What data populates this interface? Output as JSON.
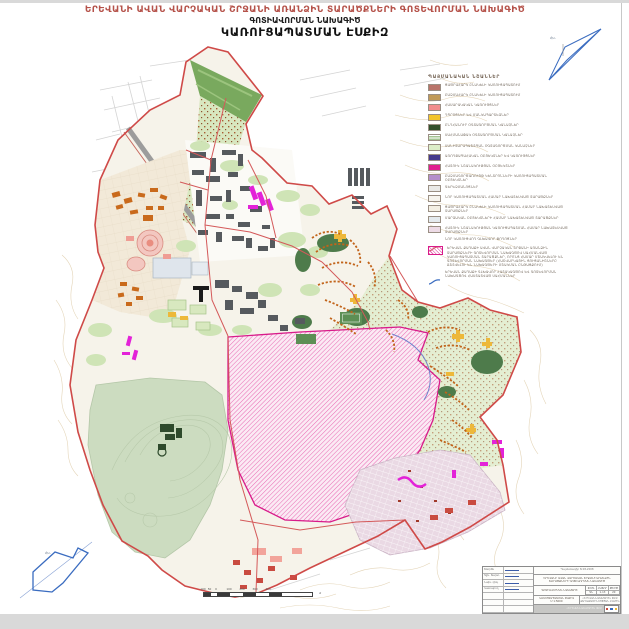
{
  "page": {
    "title_main": "ԵՐԵՎԱՆԻ ԱՎԱՆ ՎԱՐՉԱԿԱՆ ՇՐՋԱՆԻ ԱՌԱՆՁԻՆ ՏԱՐԱԾՔՆԵՐԻ ԳՈՏԵՎՈՐՄԱՆ ՆԱԽԱԳԻԾ",
    "title_sub1": "ԳՈՏԻԱՎՈՐՄԱՆ ՆԱԽԱԳԻԾ",
    "title_sub2": "ԿԱՌՈՒՑԱՊԱՏՄԱՆ ԷՍՔԻԶ",
    "north_label": "Հս."
  },
  "colors": {
    "title_red": "#b5524a",
    "boundary_red": "#cf4a48",
    "hatch_magenta": "#d81b8a",
    "north_blue": "#3a6cc0",
    "park_green": "#ccdcc0"
  },
  "legend": {
    "title": "ՊԱՅՄԱՆԱԿԱՆ ՆՇԱՆՆԵՐ",
    "items": [
      {
        "type": "swatch",
        "color": "#b9746a",
        "label": "ՑԱԾՐԱՀԱՐԿ ԲՆԱԿԵԼԻ ԿԱՌՈՒՑԱՊԱՏՈՒՄ"
      },
      {
        "type": "swatch",
        "color": "#c09a58",
        "label": "ԲԱԶՄԱՀԱՐԿ ԲՆԱԿԵԼԻ ԿԱՌՈՒՑԱՊԱՏՈՒՄ"
      },
      {
        "type": "swatch",
        "color": "#f28d8d",
        "label": "ՀԱՍԱՐԱԿԱԿԱՆ ԿԱՌՈՒՅՑՆԵՐ"
      },
      {
        "type": "swatch",
        "color": "#f3c52c",
        "label": "ԴՊՐՈՑՆԵՐ ԵՎ ՄԱՆԿԱՊԱՐՏԵԶՆԵՐ"
      },
      {
        "type": "swatch",
        "color": "#33512e",
        "label": "ԸՆԴՀԱՆՈՒՐ ՕԳՏԱԳՈՐԾՄԱՆ ԿԱՆԱՉՆԵՐ"
      },
      {
        "type": "swatch-dash",
        "color": "#a4c492",
        "label": "ՍԱՀՄԱՆԱՓԱԿ ՕԳՏԱԳՈՐԾՄԱՆ ԿԱՆԱՉՆԵՐ"
      },
      {
        "type": "swatch",
        "color": "#dcedc8",
        "label": "ՍԱՆԻՏԱՐԱՊԱՇՏՊԱՆ ՕԳՏԱԳՈՐԾՄԱՆ ԿԱՆԱՉՆԵՐ"
      },
      {
        "type": "swatch",
        "color": "#463a8e",
        "label": "ԱՌՈՂՋԱՊԱՀԱԿԱՆ ՕԲՅԵԿՏՆԵՐ ԵՎ ԿԱՌՈՒՅՑՆԵՐ"
      },
      {
        "type": "swatch",
        "color": "#e01f8f",
        "label": "ՀԱՏՈՒԿ ՆՇԱՆԱԿՈՒԹՅԱՆ ՕԲՅԵԿՏՆԵՐ"
      },
      {
        "type": "swatch",
        "color": "#b48fcb",
        "label": "ԲԱԶՄԱԳՈՐԾԱՌՈՒՅԹ ԿԵՆՏՐՈՆՆԵՐԻ ԿԱՌՈՒՑԱՊԱՏՄԱՆ ՕԲՅԵԿՏՆԵՐ"
      },
      {
        "type": "swatch",
        "color": "#e9e9e7",
        "label": "ԳԵՐԵԶՄԱՆՈՑՆԵՐ"
      },
      {
        "type": "swatch",
        "color": "#f6f4ee",
        "label": "ՆՈՐ ԿԱՌՈՒՑԱՊԱՏՄԱՆ ՀԱՄԱՐ ՆԱԽԱՏԵՍՎԱԾ ՏԱՐԱԾՔՆԵՐ"
      },
      {
        "type": "swatch",
        "color": "#f3efe4",
        "label": "ՑԱԾՐԱՀԱՐԿ ԲՆԱԿԵԼԻ ԿԱՌՈՒՑԱՊԱՏՄԱՆ ՀԱՄԱՐ ՆԱԽԱՏԵՍՎԱԾ ՏԱՐԱԾՔՆԵՐ"
      },
      {
        "type": "swatch",
        "color": "#e4eaee",
        "label": "ՄԱՐԶԱԿԱՆ ՕԲՅԵԿՏՆԵՐԻ ՀԱՄԱՐ ՆԱԽԱՏԵՍՎԱԾ ՏԱՐԱԾՔՆԵՐ"
      },
      {
        "type": "swatch",
        "color": "#eddbe6",
        "label": "ՀԱՏՈՒԿ ՆՇԱՆԱԿՈՒԹՅԱՆ ԿԱՌՈՒՑԱՊԱՏՄԱՆ ՀԱՄԱՐ ՆԱԽԱՏԵՍՎԱԾ ՏԱՐԱԾՔՆԵՐ"
      },
      {
        "type": "line-red",
        "color": "#d4595a",
        "label": "ՆՈՐ ԿԱՌՈՒՑՎՈՂ ԳԼԽԱՎՈՐ ՓՈՂՈՑՆԵՐ"
      },
      {
        "type": "hatch",
        "color": "#d81b8a",
        "label": "ԵՐԵՎԱՆ ՔԱՂԱՔԻ ԱՎԱՆ ՎԱՐՉԱԿԱՆ ՇՐՋԱՆԻ ԱՌԱՆՁԻՆ ՏԱՐԱԾՔՆԵՐԻ ԳՈՏԵՎՈՐՄԱՆ ՆԱԽԱԳԾՈՎ ՍԱՀՄԱՆՎԱԾ ԿԱՌՈՒՑԱՊԱՏՄԱՆ ՏԱՐԱԾՔՆԵՐ, ՈՐՈՆՑ ՀԱՄԱՐ ՄՇԱԿՎԵԼՈՒ ԵՆ ԳՈՏԵՎՈՐՄԱՆ ՆԱԽԱԳԾԵՐ (ՀԱՇՎԱՐԿԱՅԻՆ ՑՈՒՑԱՆԻՇՆԵՐԸ ՃՇՏՎԵԼՈՒ ԵՆ ՆԱԽԱԳԾԵՐԻ ՄՇԱԿՄԱՆ ԸՆԹԱՑՔՈՒՄ)"
      },
      {
        "type": "line-blue",
        "color": "#3a6cc0",
        "label": "ԵՐԵՎԱՆ ՔԱՂԱՔԻ ԳԼԽԱՎՈՐ ՀԱՏԱԿԱԳԾՈՎ ԵՎ ԳՈՏԵՎՈՐՄԱՆ ՆԱԽԱԳԾՈՎ ՀԱՍՏԱՏՎԱԾ ՍԱՀՄԱՆՆԵՐ"
      }
    ]
  },
  "scalebar": {
    "labels": [
      "100",
      "50",
      "0",
      "100",
      "200",
      "300",
      "400"
    ],
    "unit": "մ"
  },
  "stamp": {
    "contract_line": "Պայմանագիր N 08-2008",
    "project_title_1": "ԵՐԵՎԱՆԻ ԱՎԱՆ ՎԱՐՉԱԿԱՆ ՇՐՋԱՆԻ ԱՌԱՆՁԻՆ",
    "project_title_2": "ՏԱՐԱԾՔՆԵՐԻ ԳՈՏԵՎՈՐՄԱՆ ՆԱԽԱԳԻԾ",
    "doc_label": "ԳՈՏԻԱՎՈՐՄԱՆ ՆԱԽԱԳԻԾ",
    "cols": {
      "phase": "ՓՈՒԼ",
      "volume": "ՀԱՏՈՐ",
      "sheet": "ԹԵՐԹ"
    },
    "vals": {
      "phase": "ԳՆ",
      "volume": "1-13",
      "sheet": "20"
    },
    "sheet_label": "ԿԱՌՈՒՑԱՊԱՏՄԱՆ ԷՍՔԻԶ",
    "scale_label": "Մ 1:5000",
    "org_line_1": "«ԵՐԵՎԱՆՆԱԽԱԳԻԾ» ՓԲԸ",
    "org_line_2": "ՔԱՂԱՔԱՇԻՆՈՒԹՅԱՆ ԲԱԺԻՆ",
    "band_text": "«ԵՐԵՎԱՆՆԱԽԱԳԻԾ» ՓԲԸ",
    "signatures": [
      {
        "role": "Տնօրեն"
      },
      {
        "role": "Գլխ. ճարտ."
      },
      {
        "role": "Նախ. ղեկ."
      },
      {
        "role": "Կատարող"
      }
    ]
  }
}
